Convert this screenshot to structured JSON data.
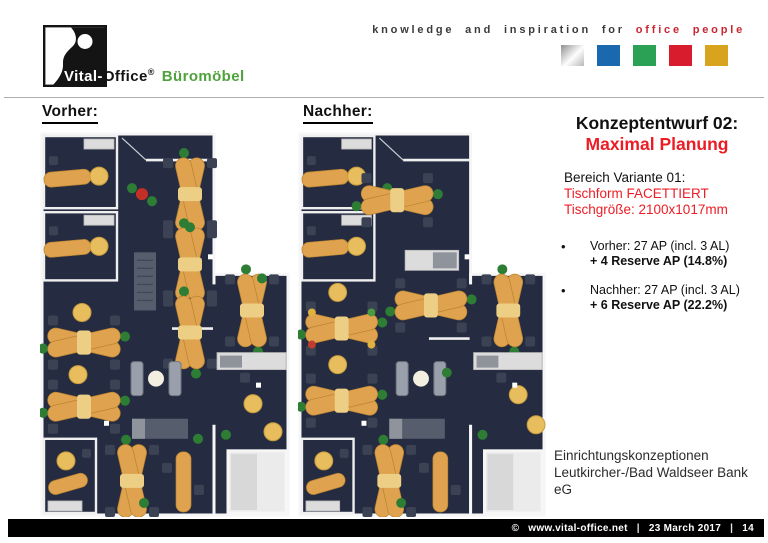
{
  "palette": {
    "brand_green": "#4fa33c",
    "title_red": "#ed1c24",
    "tagline_red": "#cb2531",
    "square_blue": "#1a68ad",
    "square_green": "#2aa155",
    "square_red": "#d91b2e",
    "square_gold": "#d8a31d",
    "floor_navy": "#252c42",
    "desk_orange": "#dfa24f",
    "footer_bg": "#000000"
  },
  "header": {
    "logo": {
      "brand_part1": "Vital-",
      "brand_part2": "Office",
      "registered": "®",
      "brand_suffix": "Büromöbel"
    },
    "tagline": {
      "gray": "knowledge and inspiration for",
      "red": "office people"
    },
    "color_squares": [
      "silver",
      "blue",
      "green",
      "red",
      "gold"
    ]
  },
  "plans": {
    "before": {
      "label": "Vorher:"
    },
    "after": {
      "label": "Nachher:"
    }
  },
  "sidebar": {
    "title_line1": "Konzeptentwurf 02:",
    "title_line2": "Maximal Planung",
    "variant": {
      "line1": "Bereich Variante 01:",
      "line2": "Tischform FACETTIERT",
      "line3": "Tischgröße: 2100x1017mm"
    },
    "bullets": [
      {
        "line1": "Vorher: 27 AP (incl. 3 AL)",
        "line2": "+ 4 Reserve AP (14.8%)"
      },
      {
        "line1": "Nachher: 27 AP (incl. 3 AL)",
        "line2": "+ 6 Reserve AP (22.2%)"
      }
    ],
    "client": {
      "line1": "Einrichtungskonzeptionen",
      "line2": "Leutkircher-/Bad Waldseer Bank",
      "line3": "eG"
    }
  },
  "footer": {
    "copyright": "©",
    "url": "www.vital-office.net",
    "sep": "|",
    "date": "23 March 2017",
    "page": "14"
  }
}
